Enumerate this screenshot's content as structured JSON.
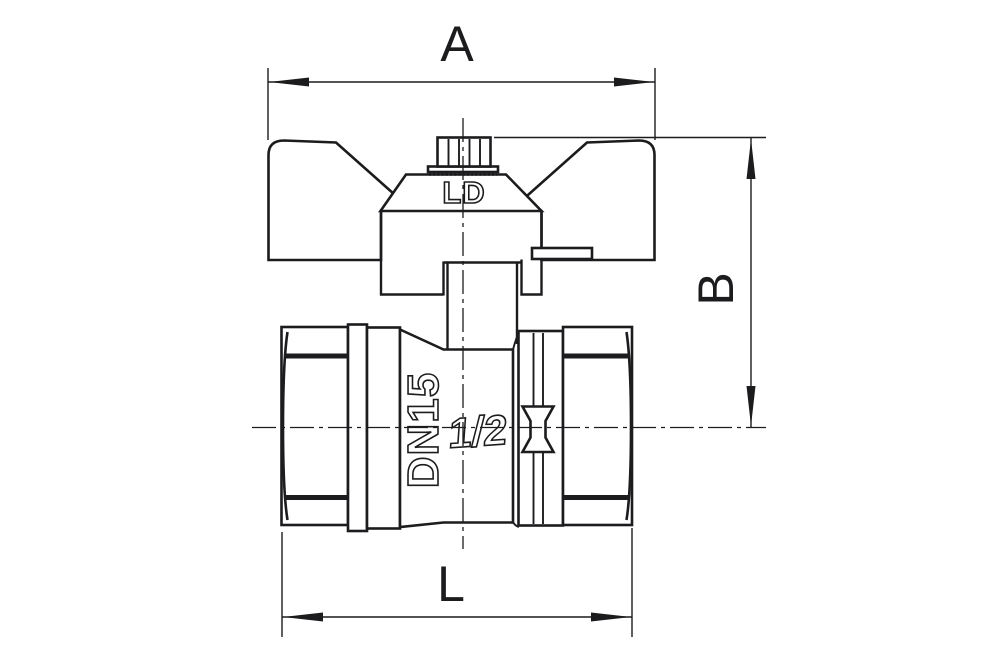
{
  "drawing": {
    "dimensions": {
      "a": "A",
      "b": "B",
      "l": "L"
    },
    "markings": {
      "brand": "LD",
      "nominal_bore": "DN15",
      "size": "1/2"
    },
    "colors": {
      "line": "#1c1c1e",
      "background": "#ffffff"
    }
  }
}
